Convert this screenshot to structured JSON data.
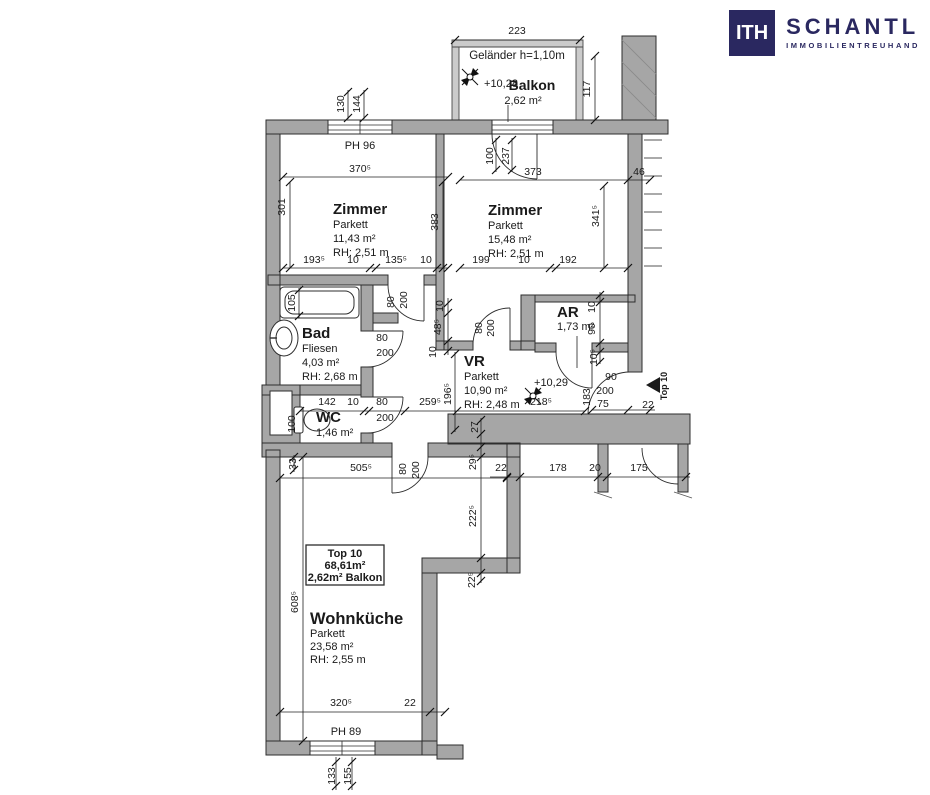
{
  "logo": {
    "monogram": "ITH",
    "name": "SCHANTL",
    "subtitle": "IMMOBILIENTREUHAND",
    "color": "#2a2860"
  },
  "plan": {
    "unit_box": {
      "lines": [
        "Top 10",
        "68,61m²",
        "2,62m² Balkon"
      ]
    },
    "rooms": [
      {
        "id": "zimmer-1",
        "lines": [
          "Zimmer",
          "Parkett",
          "11,43 m²",
          "RH: 2,51 m"
        ],
        "x": 333,
        "y": 214,
        "gap": 14
      },
      {
        "id": "zimmer-2",
        "lines": [
          "Zimmer",
          "Parkett",
          "15,48 m²",
          "RH: 2,51 m"
        ],
        "x": 488,
        "y": 215,
        "gap": 14
      },
      {
        "id": "bad",
        "lines": [
          "Bad",
          "Fliesen",
          "4,03 m²",
          "RH: 2,68 m"
        ],
        "x": 302,
        "y": 338,
        "gap": 14
      },
      {
        "id": "wc",
        "lines": [
          "WC",
          "1,46 m²"
        ],
        "x": 316,
        "y": 422,
        "gap": 14
      },
      {
        "id": "vr",
        "lines": [
          "VR",
          "Parkett",
          "10,90 m²",
          "RH: 2,48 m"
        ],
        "x": 464,
        "y": 366,
        "gap": 14
      },
      {
        "id": "ar",
        "lines": [
          "AR",
          "1,73 m²"
        ],
        "x": 557,
        "y": 317,
        "gap": 13
      },
      {
        "id": "wohnkueche",
        "lines": [
          "Wohnküche",
          "Parkett",
          "23,58 m²",
          "RH: 2,55 m"
        ],
        "x": 310,
        "y": 624,
        "gap": 13,
        "big": true
      }
    ],
    "annotations": [
      {
        "t": "Geländer h=1,10m",
        "x": 517,
        "y": 59,
        "s": 11.5
      },
      {
        "t": "+10,28",
        "x": 501,
        "y": 87,
        "s": 11
      },
      {
        "t": "Balkon",
        "x": 532,
        "y": 90,
        "s": 14,
        "b": 1
      },
      {
        "t": "2,62 m²",
        "x": 523,
        "y": 104,
        "s": 11
      },
      {
        "t": "PH 96",
        "x": 360,
        "y": 149,
        "s": 11
      },
      {
        "t": "+10,29",
        "x": 551,
        "y": 386,
        "s": 11
      },
      {
        "t": "PH 89",
        "x": 346,
        "y": 735,
        "s": 11
      },
      {
        "t": "Top 10",
        "x": 667,
        "y": 386,
        "s": 9,
        "b": 1,
        "r": 1
      }
    ],
    "dimensions": [
      {
        "t": "223",
        "x": 517,
        "y": 34
      },
      {
        "t": "117",
        "x": 590,
        "y": 89,
        "r": 1
      },
      {
        "t": "130",
        "x": 344,
        "y": 104,
        "r": 1
      },
      {
        "t": "144",
        "x": 360,
        "y": 104,
        "r": 1
      },
      {
        "t": "370⁵",
        "x": 360,
        "y": 172
      },
      {
        "t": "301",
        "x": 285,
        "y": 207,
        "r": 1
      },
      {
        "t": "383",
        "x": 438,
        "y": 222,
        "r": 1
      },
      {
        "t": "100",
        "x": 493,
        "y": 156,
        "r": 1
      },
      {
        "t": "237",
        "x": 509,
        "y": 156,
        "r": 1
      },
      {
        "t": "373",
        "x": 533,
        "y": 175
      },
      {
        "t": "46",
        "x": 639,
        "y": 175
      },
      {
        "t": "341⁵",
        "x": 599,
        "y": 216,
        "r": 1
      },
      {
        "t": "193⁵",
        "x": 314,
        "y": 263
      },
      {
        "t": "10",
        "x": 353,
        "y": 263
      },
      {
        "t": "135⁵",
        "x": 396,
        "y": 263
      },
      {
        "t": "10",
        "x": 426,
        "y": 263
      },
      {
        "t": "199",
        "x": 481,
        "y": 263
      },
      {
        "t": "10",
        "x": 524,
        "y": 263
      },
      {
        "t": "192",
        "x": 568,
        "y": 263
      },
      {
        "t": "105",
        "x": 295,
        "y": 303,
        "r": 1
      },
      {
        "t": "80",
        "x": 394,
        "y": 302,
        "r": 1
      },
      {
        "t": "200",
        "x": 407,
        "y": 300,
        "r": 1
      },
      {
        "t": "10",
        "x": 443,
        "y": 306,
        "r": 1
      },
      {
        "t": "48⁵",
        "x": 441,
        "y": 327,
        "r": 1
      },
      {
        "t": "10",
        "x": 436,
        "y": 352,
        "r": 1
      },
      {
        "t": "80",
        "x": 382,
        "y": 341
      },
      {
        "t": "200",
        "x": 385,
        "y": 356
      },
      {
        "t": "80",
        "x": 482,
        "y": 328,
        "r": 1
      },
      {
        "t": "200",
        "x": 494,
        "y": 328,
        "r": 1
      },
      {
        "t": "10",
        "x": 595,
        "y": 307,
        "r": 1
      },
      {
        "t": "90",
        "x": 595,
        "y": 329,
        "r": 1
      },
      {
        "t": "10⁵",
        "x": 597,
        "y": 357,
        "r": 1
      },
      {
        "t": "142",
        "x": 327,
        "y": 405
      },
      {
        "t": "10",
        "x": 353,
        "y": 405
      },
      {
        "t": "80",
        "x": 382,
        "y": 405
      },
      {
        "t": "200",
        "x": 385,
        "y": 421
      },
      {
        "t": "259⁵",
        "x": 430,
        "y": 405
      },
      {
        "t": "218⁵",
        "x": 541,
        "y": 405
      },
      {
        "t": "196⁵",
        "x": 451,
        "y": 394,
        "r": 1
      },
      {
        "t": "100",
        "x": 295,
        "y": 424,
        "r": 1
      },
      {
        "t": "27",
        "x": 478,
        "y": 427,
        "r": 1
      },
      {
        "t": "183",
        "x": 590,
        "y": 397,
        "r": 1
      },
      {
        "t": "90",
        "x": 611,
        "y": 380
      },
      {
        "t": "200",
        "x": 605,
        "y": 394
      },
      {
        "t": "75",
        "x": 603,
        "y": 407
      },
      {
        "t": "22",
        "x": 648,
        "y": 408
      },
      {
        "t": "33",
        "x": 296,
        "y": 464,
        "r": 1
      },
      {
        "t": "505⁵",
        "x": 361,
        "y": 471
      },
      {
        "t": "80",
        "x": 406,
        "y": 469,
        "r": 1
      },
      {
        "t": "200",
        "x": 419,
        "y": 470,
        "r": 1
      },
      {
        "t": "29⁵",
        "x": 476,
        "y": 462,
        "r": 1
      },
      {
        "t": "22",
        "x": 501,
        "y": 471
      },
      {
        "t": "178",
        "x": 558,
        "y": 471
      },
      {
        "t": "20",
        "x": 595,
        "y": 471
      },
      {
        "t": "175",
        "x": 639,
        "y": 471
      },
      {
        "t": "222⁵",
        "x": 476,
        "y": 516,
        "r": 1
      },
      {
        "t": "22⁵",
        "x": 475,
        "y": 580,
        "r": 1
      },
      {
        "t": "608⁵",
        "x": 298,
        "y": 602,
        "r": 1
      },
      {
        "t": "320⁵",
        "x": 341,
        "y": 706
      },
      {
        "t": "22",
        "x": 410,
        "y": 706
      },
      {
        "t": "133",
        "x": 335,
        "y": 776,
        "r": 1
      },
      {
        "t": "155",
        "x": 351,
        "y": 776,
        "r": 1
      }
    ]
  }
}
